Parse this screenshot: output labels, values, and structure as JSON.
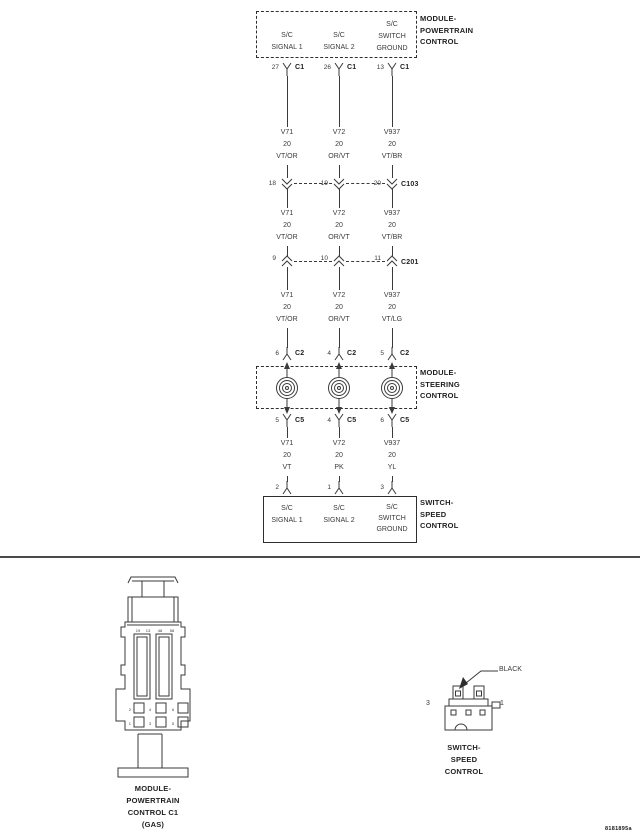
{
  "doc_number": "8181895a",
  "colors": {
    "line": "#3a3a3a",
    "box": "#2e2e2e",
    "text_dark": "#1f1f1f"
  },
  "modules": {
    "pcm": {
      "lines": [
        "MODULE-",
        "POWERTRAIN",
        "CONTROL"
      ]
    },
    "steering": {
      "lines": [
        "MODULE-",
        "STEERING",
        "CONTROL"
      ]
    },
    "speed_switch": {
      "lines": [
        "SWITCH-",
        "SPEED",
        "CONTROL"
      ]
    }
  },
  "pcm_box_signals": {
    "sig1": [
      "S/C",
      "SIGNAL 1"
    ],
    "sig2": [
      "S/C",
      "SIGNAL 2"
    ],
    "ground": [
      "S/C",
      "SWITCH",
      "GROUND"
    ]
  },
  "switch_box_signals": {
    "sig1": [
      "S/C",
      "SIGNAL 1"
    ],
    "sig2": [
      "S/C",
      "SIGNAL 2"
    ],
    "ground": [
      "S/C",
      "SWITCH",
      "GROUND"
    ]
  },
  "connector_rows": {
    "c1": {
      "label": "C1",
      "pins": [
        "27",
        "26",
        "13"
      ]
    },
    "c103": {
      "label": "C103",
      "pins": [
        "18",
        "19",
        "20"
      ]
    },
    "c201": {
      "label": "C201",
      "pins": [
        "9",
        "10",
        "11"
      ]
    },
    "c2": {
      "label": "C2",
      "pins": [
        "6",
        "4",
        "5"
      ]
    },
    "c5": {
      "label": "C5",
      "pins": [
        "5",
        "4",
        "6"
      ]
    },
    "switch": {
      "pins": [
        "2",
        "1",
        "3"
      ]
    }
  },
  "wires": {
    "seg1": [
      [
        "V71",
        "20",
        "VT/OR"
      ],
      [
        "V72",
        "20",
        "OR/VT"
      ],
      [
        "V937",
        "20",
        "VT/BR"
      ]
    ],
    "seg2": [
      [
        "V71",
        "20",
        "VT/OR"
      ],
      [
        "V72",
        "20",
        "OR/VT"
      ],
      [
        "V937",
        "20",
        "VT/BR"
      ]
    ],
    "seg3": [
      [
        "V71",
        "20",
        "VT/OR"
      ],
      [
        "V72",
        "20",
        "OR/VT"
      ],
      [
        "V937",
        "20",
        "VT/LG"
      ]
    ],
    "seg4": [
      [
        "V71",
        "20",
        "VT"
      ],
      [
        "V72",
        "20",
        "PK"
      ],
      [
        "V937",
        "20",
        "YL"
      ]
    ]
  },
  "connector_views": {
    "pcm": {
      "caption": [
        "MODULE-",
        "POWERTRAIN",
        "CONTROL C1",
        "(GAS)"
      ],
      "slot_numbers": [
        "19",
        "13",
        "48",
        "58"
      ],
      "cavities_row1": [
        "2",
        "4",
        "6"
      ],
      "cavities_row2": [
        "1",
        "3",
        "5"
      ]
    },
    "speed": {
      "caption": [
        "SWITCH-",
        "SPEED",
        "CONTROL"
      ],
      "color_label": "BLACK",
      "pin_left": "3",
      "pin_right": "1"
    }
  }
}
